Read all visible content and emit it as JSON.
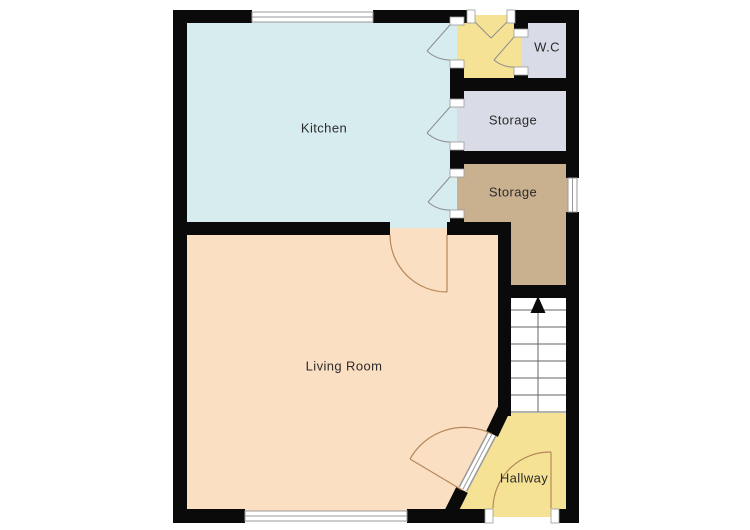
{
  "plan": {
    "rooms": {
      "kitchen": {
        "label": "Kitchen",
        "color": "#d7ecee"
      },
      "living_room": {
        "label": "Living Room",
        "color": "#fbdfc3"
      },
      "wc": {
        "label": "W.C",
        "color": "#d9dce6"
      },
      "storage_upper": {
        "label": "Storage",
        "color": "#d9dce6"
      },
      "storage_lower": {
        "label": "Storage",
        "color": "#c9b190"
      },
      "hallway": {
        "label": "Hallway",
        "color": "#f5e295"
      },
      "entry_lobby": {
        "color": "#f5e295"
      },
      "stairs": {
        "color": "#ffffff"
      }
    },
    "colors": {
      "wall": "#0a0a0a",
      "background": "#ffffff",
      "window_fill": "#ffffff",
      "window_frame": "#9a9a9a",
      "door_swing_gray": "#8d8d8d",
      "door_swing_brown": "#b5885a",
      "stair_line": "#666666",
      "label_text": "#2b2b2b"
    }
  }
}
